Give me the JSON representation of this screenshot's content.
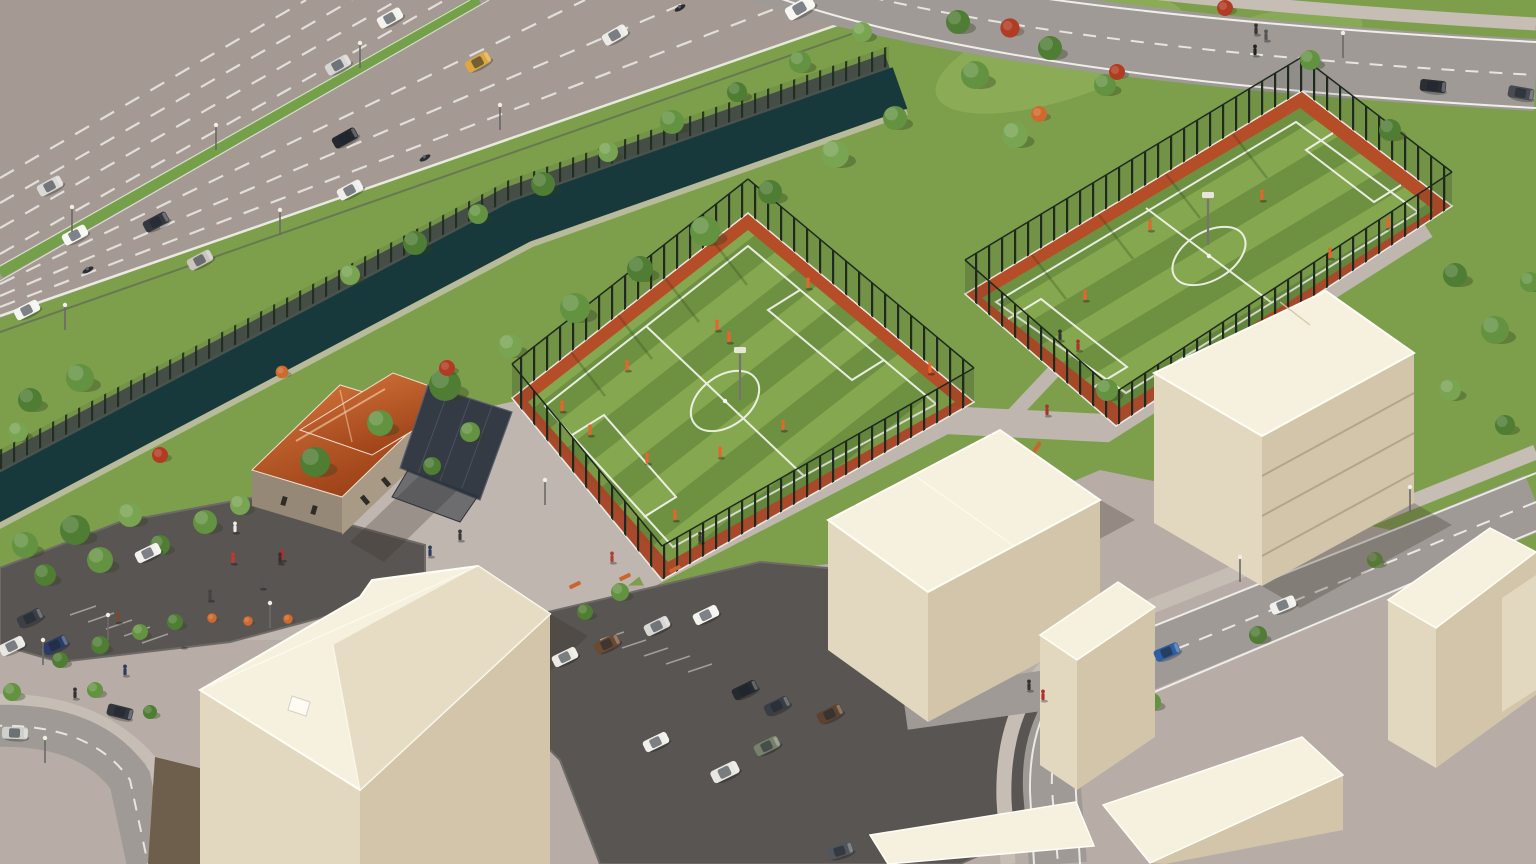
{
  "scene": {
    "type": "3d-architectural-aerial-render",
    "description": "Aerial 3D architectural rendering of an urban sports complex: two fenced artificial-turf football pitches with orange perimeter bands and players in orange kits, a tree-lined canal and landscaped bank, a multi-lane divided highway with traffic in the upper left, a curving access road at the top right, a stone clubhouse with a terracotta hipped roof and dark flat-roof annex, surface parking lots with parked cars, pedestrian plazas with trees, benches and people, and pale cream massing-model apartment blocks along the streets in the foreground.",
    "features": {
      "pitch_count": 2,
      "pitch_player_kit": "orange",
      "highway_lanes_visible": 8,
      "highway_median": "green planted strip with street lights",
      "canal": "dark green-blue water channel between retaining walls",
      "clubhouse_roof": "terracotta tiles",
      "massing_buildings": "unrendered cream volumes",
      "weather": "clear daylight"
    }
  },
  "palette": {
    "pavement": "#b7aca6",
    "plaza": "#c0b6b0",
    "lawn": "#7d9f4b",
    "lawn_bright": "#97b563",
    "grass_light": "#84a74f",
    "grass_dark": "#6d9141",
    "asphalt": "#595552",
    "road": "#9f9a95",
    "highway": "#a59a93",
    "sidewalk": "#c6bdb5",
    "median_green": "#74a04a",
    "water": "#17393c",
    "canal_wall": "#4a524c",
    "fence_dark": "#1f2a1e",
    "pitch_border": "#b84b28",
    "line_white": "#f7f7f3",
    "cream_roof": "#f6f1de",
    "cream_wall": "#e2d8bf",
    "cream_wall_dark": "#d2c5a9",
    "roof_orange_1": "#d4763c",
    "roof_orange_2": "#9c4017",
    "flat_roof": "#343b45",
    "stone_wall": "#a89a85",
    "stone_wall_dark": "#968876",
    "tree_1": "#4e7d33",
    "tree_2": "#639241",
    "tree_3": "#79a452",
    "bush_red": "#b23b24",
    "bush_orange": "#cf6a2f",
    "kit_orange": "#e8642c",
    "bench_orange": "#c9652f",
    "dirt": "#6e5e4c",
    "shadow": "rgba(60,50,42,0.28)"
  }
}
